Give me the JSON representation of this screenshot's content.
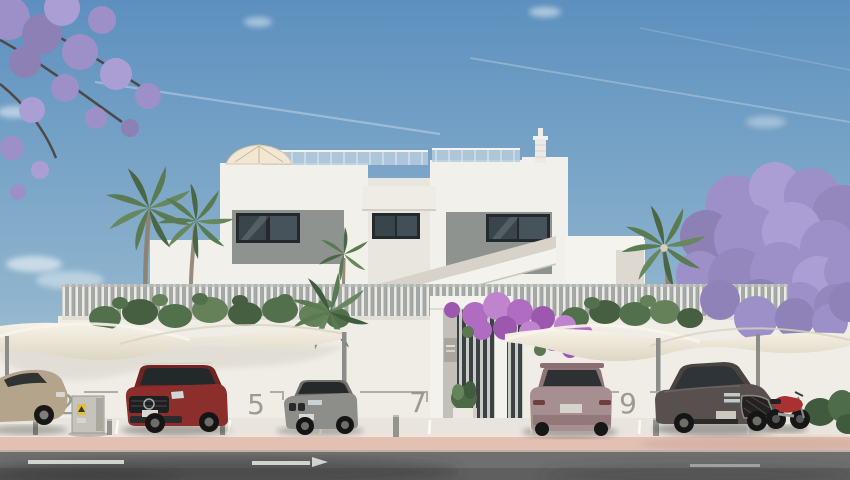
{
  "parking": {
    "bays": [
      {
        "number": "2"
      },
      {
        "number": "5"
      },
      {
        "number": "7"
      },
      {
        "number": "9"
      }
    ]
  },
  "colors": {
    "sky_top": "#5d90bf",
    "sky_mid": "#8fb4cd",
    "sky_horizon": "#c6d7e0",
    "building": "#f2f0ea",
    "building_shade": "#e9e6df",
    "accent_panel": "#8f938f",
    "window": "#39454b",
    "fence_slat": "#a4a9a7",
    "fence_light": "#eceae4",
    "wall": "#f0ede7",
    "canopy_light": "#f7f3e8",
    "canopy_shade": "#ddd6c4",
    "hedge": "#53704c",
    "palm": "#5a7a52",
    "jacaranda": "#9d90c8",
    "bougainvillea": "#b06cc0",
    "road": "#6f6f6f",
    "sidewalk": "#e2c0b2",
    "apron": "#e9e5de",
    "bay_number": "#97948c",
    "car_beige": "#b3a48b",
    "car_red": "#8c2f2c",
    "car_gray": "#8d8d89",
    "car_mauve": "#a78e90",
    "car_dark": "#57504e",
    "moto_red": "#a93230"
  }
}
